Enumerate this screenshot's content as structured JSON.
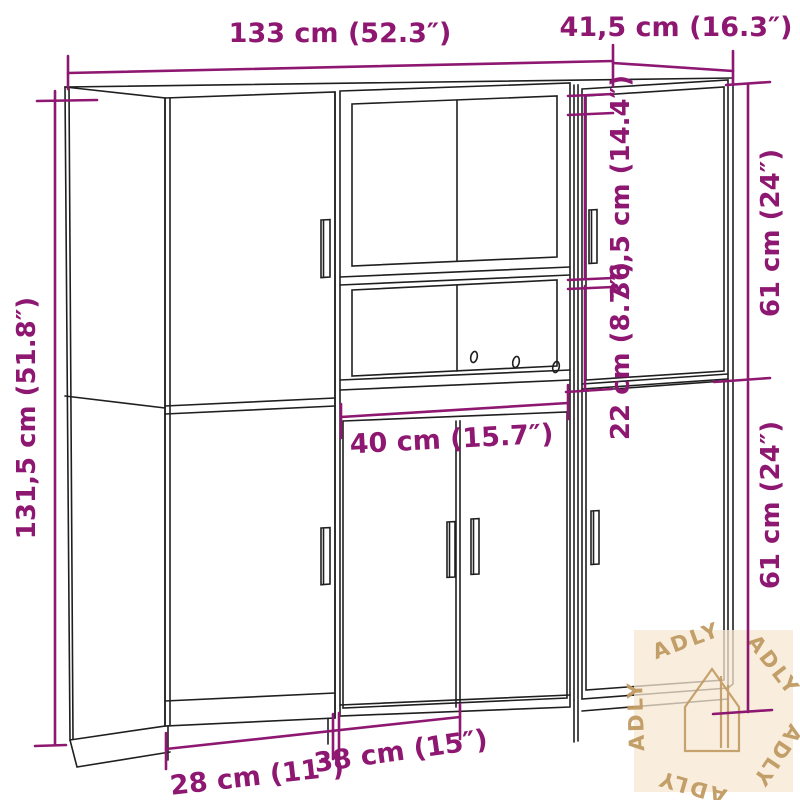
{
  "dimensions": {
    "total_width": "133 cm (52.3″)",
    "depth": "41,5 cm (16.3″)",
    "total_height": "131,5 cm (51.8″)",
    "upper_opening_height": "36,5 cm (14.4″)",
    "lower_opening_height": "22 cm (8.7″)",
    "right_upper_height": "61 cm (24″)",
    "right_lower_height": "61 cm (24″)",
    "middle_width": "40 cm (15.7″)",
    "bottom_left_width": "28 cm (11″)",
    "bottom_middle_width": "38 cm (15″)"
  },
  "watermark": {
    "brand": "ADLY",
    "icon": "house-outline-icon"
  },
  "colors": {
    "dimension_annotation": "#8e1871",
    "line_art": "#1f1f1f",
    "watermark_text": "#c09a62",
    "watermark_background": "#f7e7d2"
  }
}
